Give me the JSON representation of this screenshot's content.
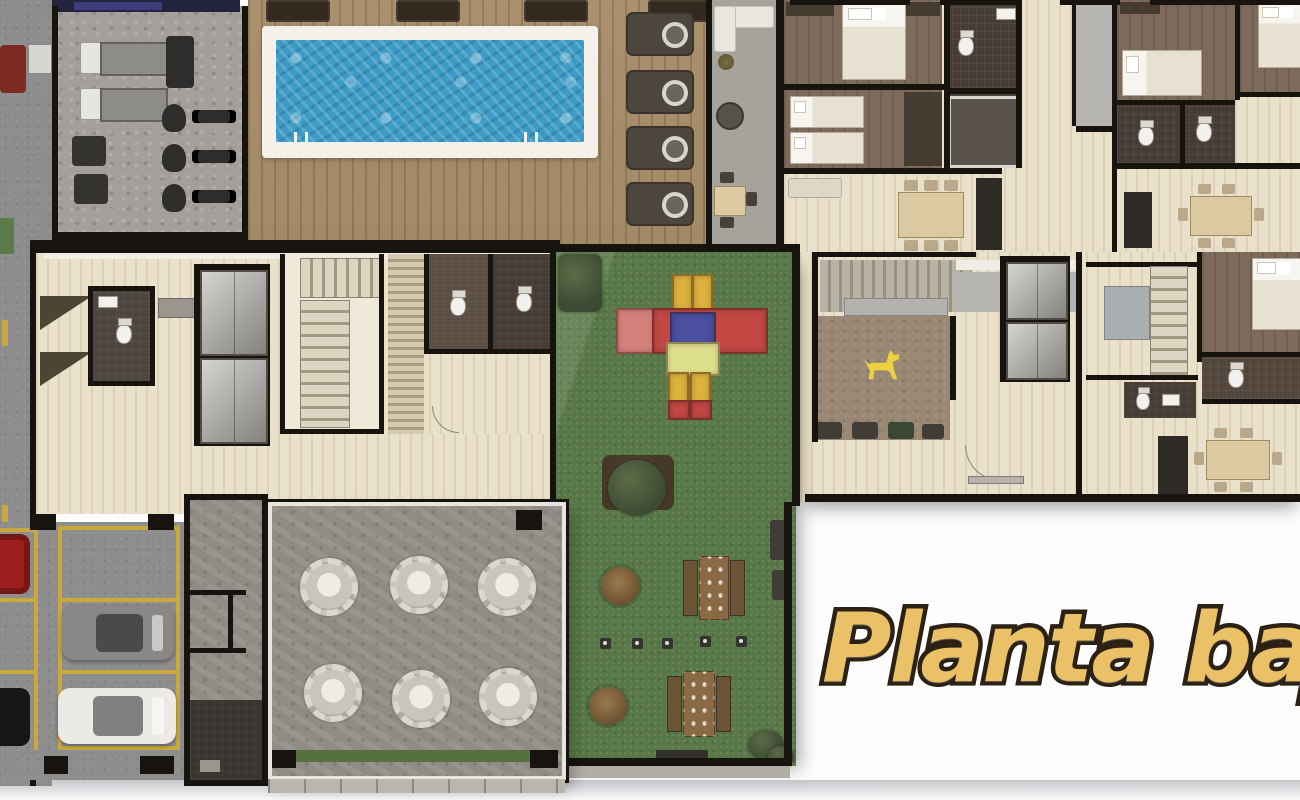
{
  "title": {
    "text": "Planta baja"
  },
  "icons": {
    "dog": "dog-icon (yellow dog silhouette marking pet area)"
  },
  "colors": {
    "title_fill": "#eac166",
    "title_outline": "#2b2115",
    "wall": "#17130e",
    "pool_water": "#3d9cc6",
    "pool_deck": "#a28a67",
    "water_border": "#f3f1ea",
    "grass": "#587947",
    "gym_floor": "#a3a09c",
    "lounge_floor": "#a6a29c",
    "unit_floor": "#eae1ca",
    "bedroom_floor": "#7d6a5a",
    "bath_floor": "#463c33",
    "dog_area": "#9a8875",
    "dog_icon": "#ecd23f",
    "event_floor": "#908c85",
    "asphalt": "#8d8d8d",
    "parking_line": "#c9a93e",
    "play_red": "#c24743",
    "play_pink": "#d4807b",
    "play_blue": "#4b4fa0",
    "play_yellow": "#ddb23f",
    "play_lime": "#dfe08d",
    "picnic_wood": "#8a6a44",
    "car_red": "#9e1f1d",
    "car_gray": "#8a8886",
    "car_white": "#eceae6",
    "car_black": "#161616"
  }
}
